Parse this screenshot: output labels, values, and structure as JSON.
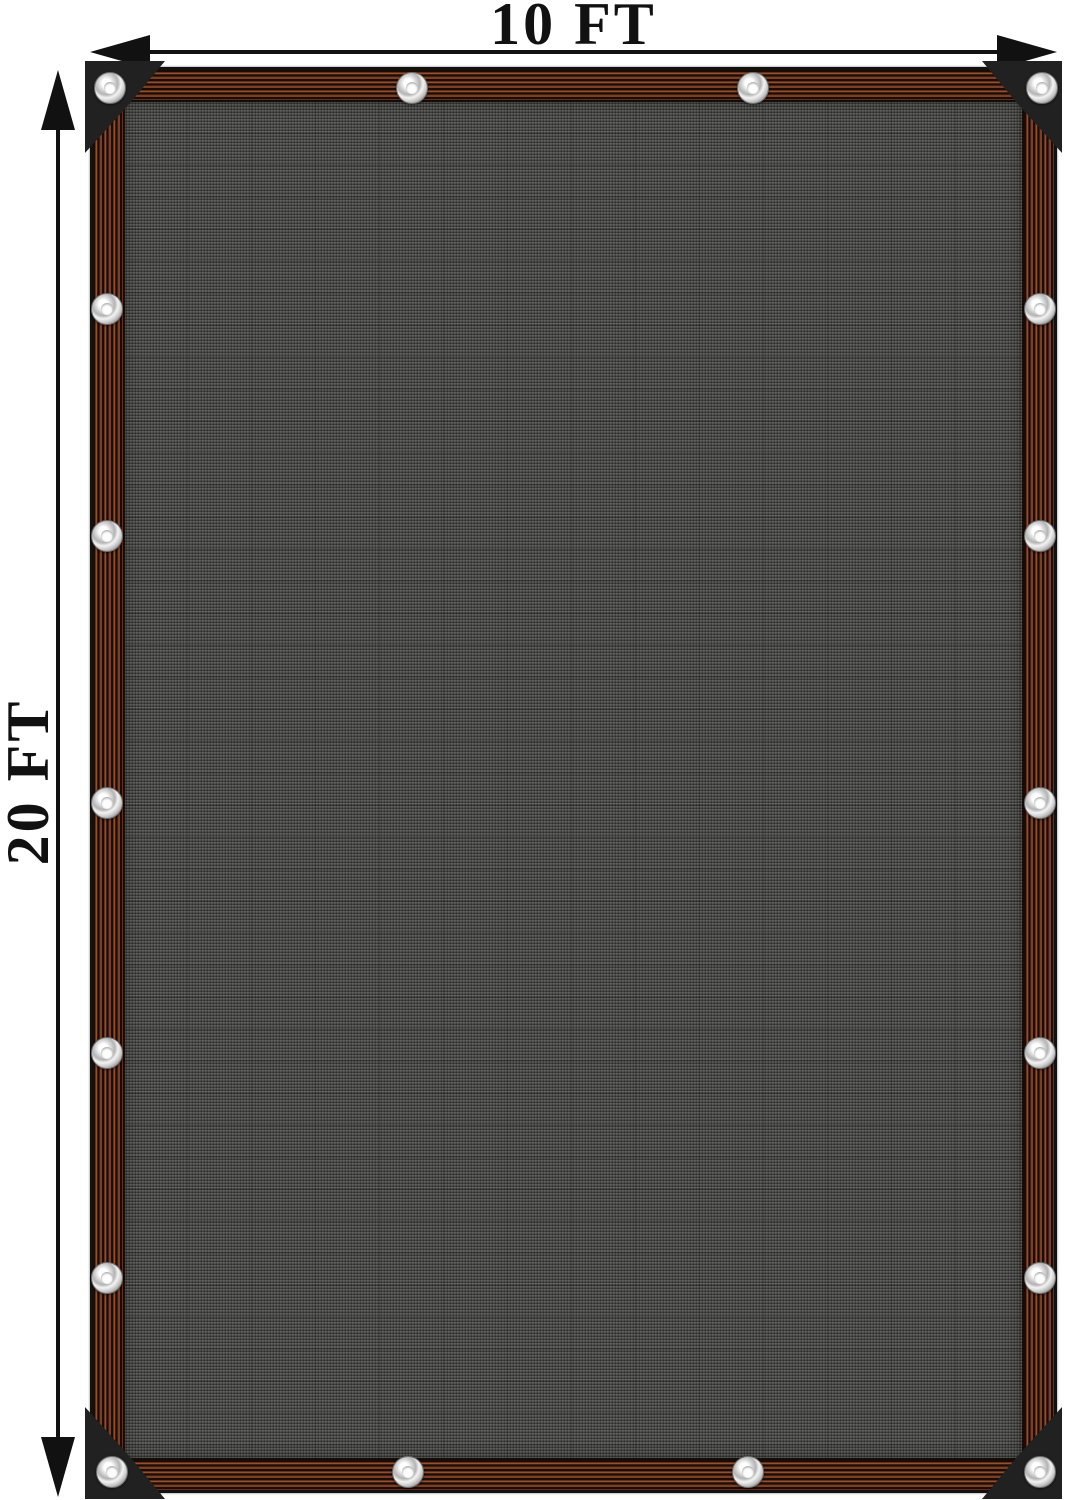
{
  "dimension_annotations": {
    "width": {
      "label": "10 FT"
    },
    "height": {
      "label": "20 FT"
    }
  },
  "colors": {
    "page-bg": "#ffffff",
    "ink": "#111111",
    "edge-black": "#141210",
    "border-rust": "#63301d",
    "border-rust-light": "#93502c",
    "border-dark": "#1c0c06",
    "mesh-base": "#4e4e4c",
    "corner-patch": "#212121",
    "grommet-ring": "#d9d9d9",
    "grommet-hole": "#fdfdfd"
  },
  "tarp": {
    "grommet_count": 18,
    "grommets": [
      [
        20,
        21
      ],
      [
        322,
        21
      ],
      [
        663,
        21
      ],
      [
        952,
        21
      ],
      [
        17,
        242
      ],
      [
        17,
        469
      ],
      [
        17,
        736
      ],
      [
        17,
        986
      ],
      [
        17,
        1211
      ],
      [
        950,
        242
      ],
      [
        950,
        469
      ],
      [
        950,
        736
      ],
      [
        950,
        986
      ],
      [
        950,
        1211
      ],
      [
        22,
        1405
      ],
      [
        318,
        1405
      ],
      [
        658,
        1405
      ],
      [
        950,
        1405
      ]
    ]
  }
}
